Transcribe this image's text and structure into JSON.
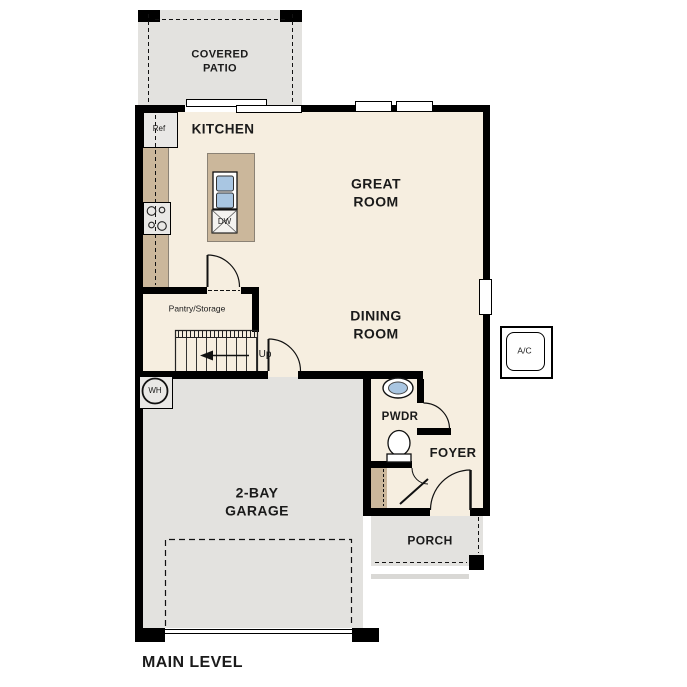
{
  "title": "MAIN LEVEL",
  "colors": {
    "wall": "#000000",
    "floor": "#f6eee0",
    "hardscape": "#e3e2df",
    "casework": "#cbb79b",
    "appliance": "#e9e8e6",
    "fixture_blue": "#a9c6e2"
  },
  "rooms": {
    "covered_patio": {
      "line1": "COVERED",
      "line2": "PATIO"
    },
    "kitchen": {
      "label": "KITCHEN"
    },
    "great_room": {
      "line1": "GREAT",
      "line2": "ROOM"
    },
    "dining_room": {
      "line1": "DINING",
      "line2": "ROOM"
    },
    "pantry": {
      "label": "Pantry/Storage"
    },
    "stairs": {
      "label": "Up"
    },
    "powder": {
      "label": "PWDR"
    },
    "foyer": {
      "label": "FOYER"
    },
    "porch": {
      "label": "PORCH"
    },
    "garage": {
      "line1": "2-BAY",
      "line2": "GARAGE"
    }
  },
  "fixtures": {
    "refrigerator": "Ref",
    "dishwasher": "DW",
    "water_heater": "WH",
    "ac_unit": "A/C"
  }
}
